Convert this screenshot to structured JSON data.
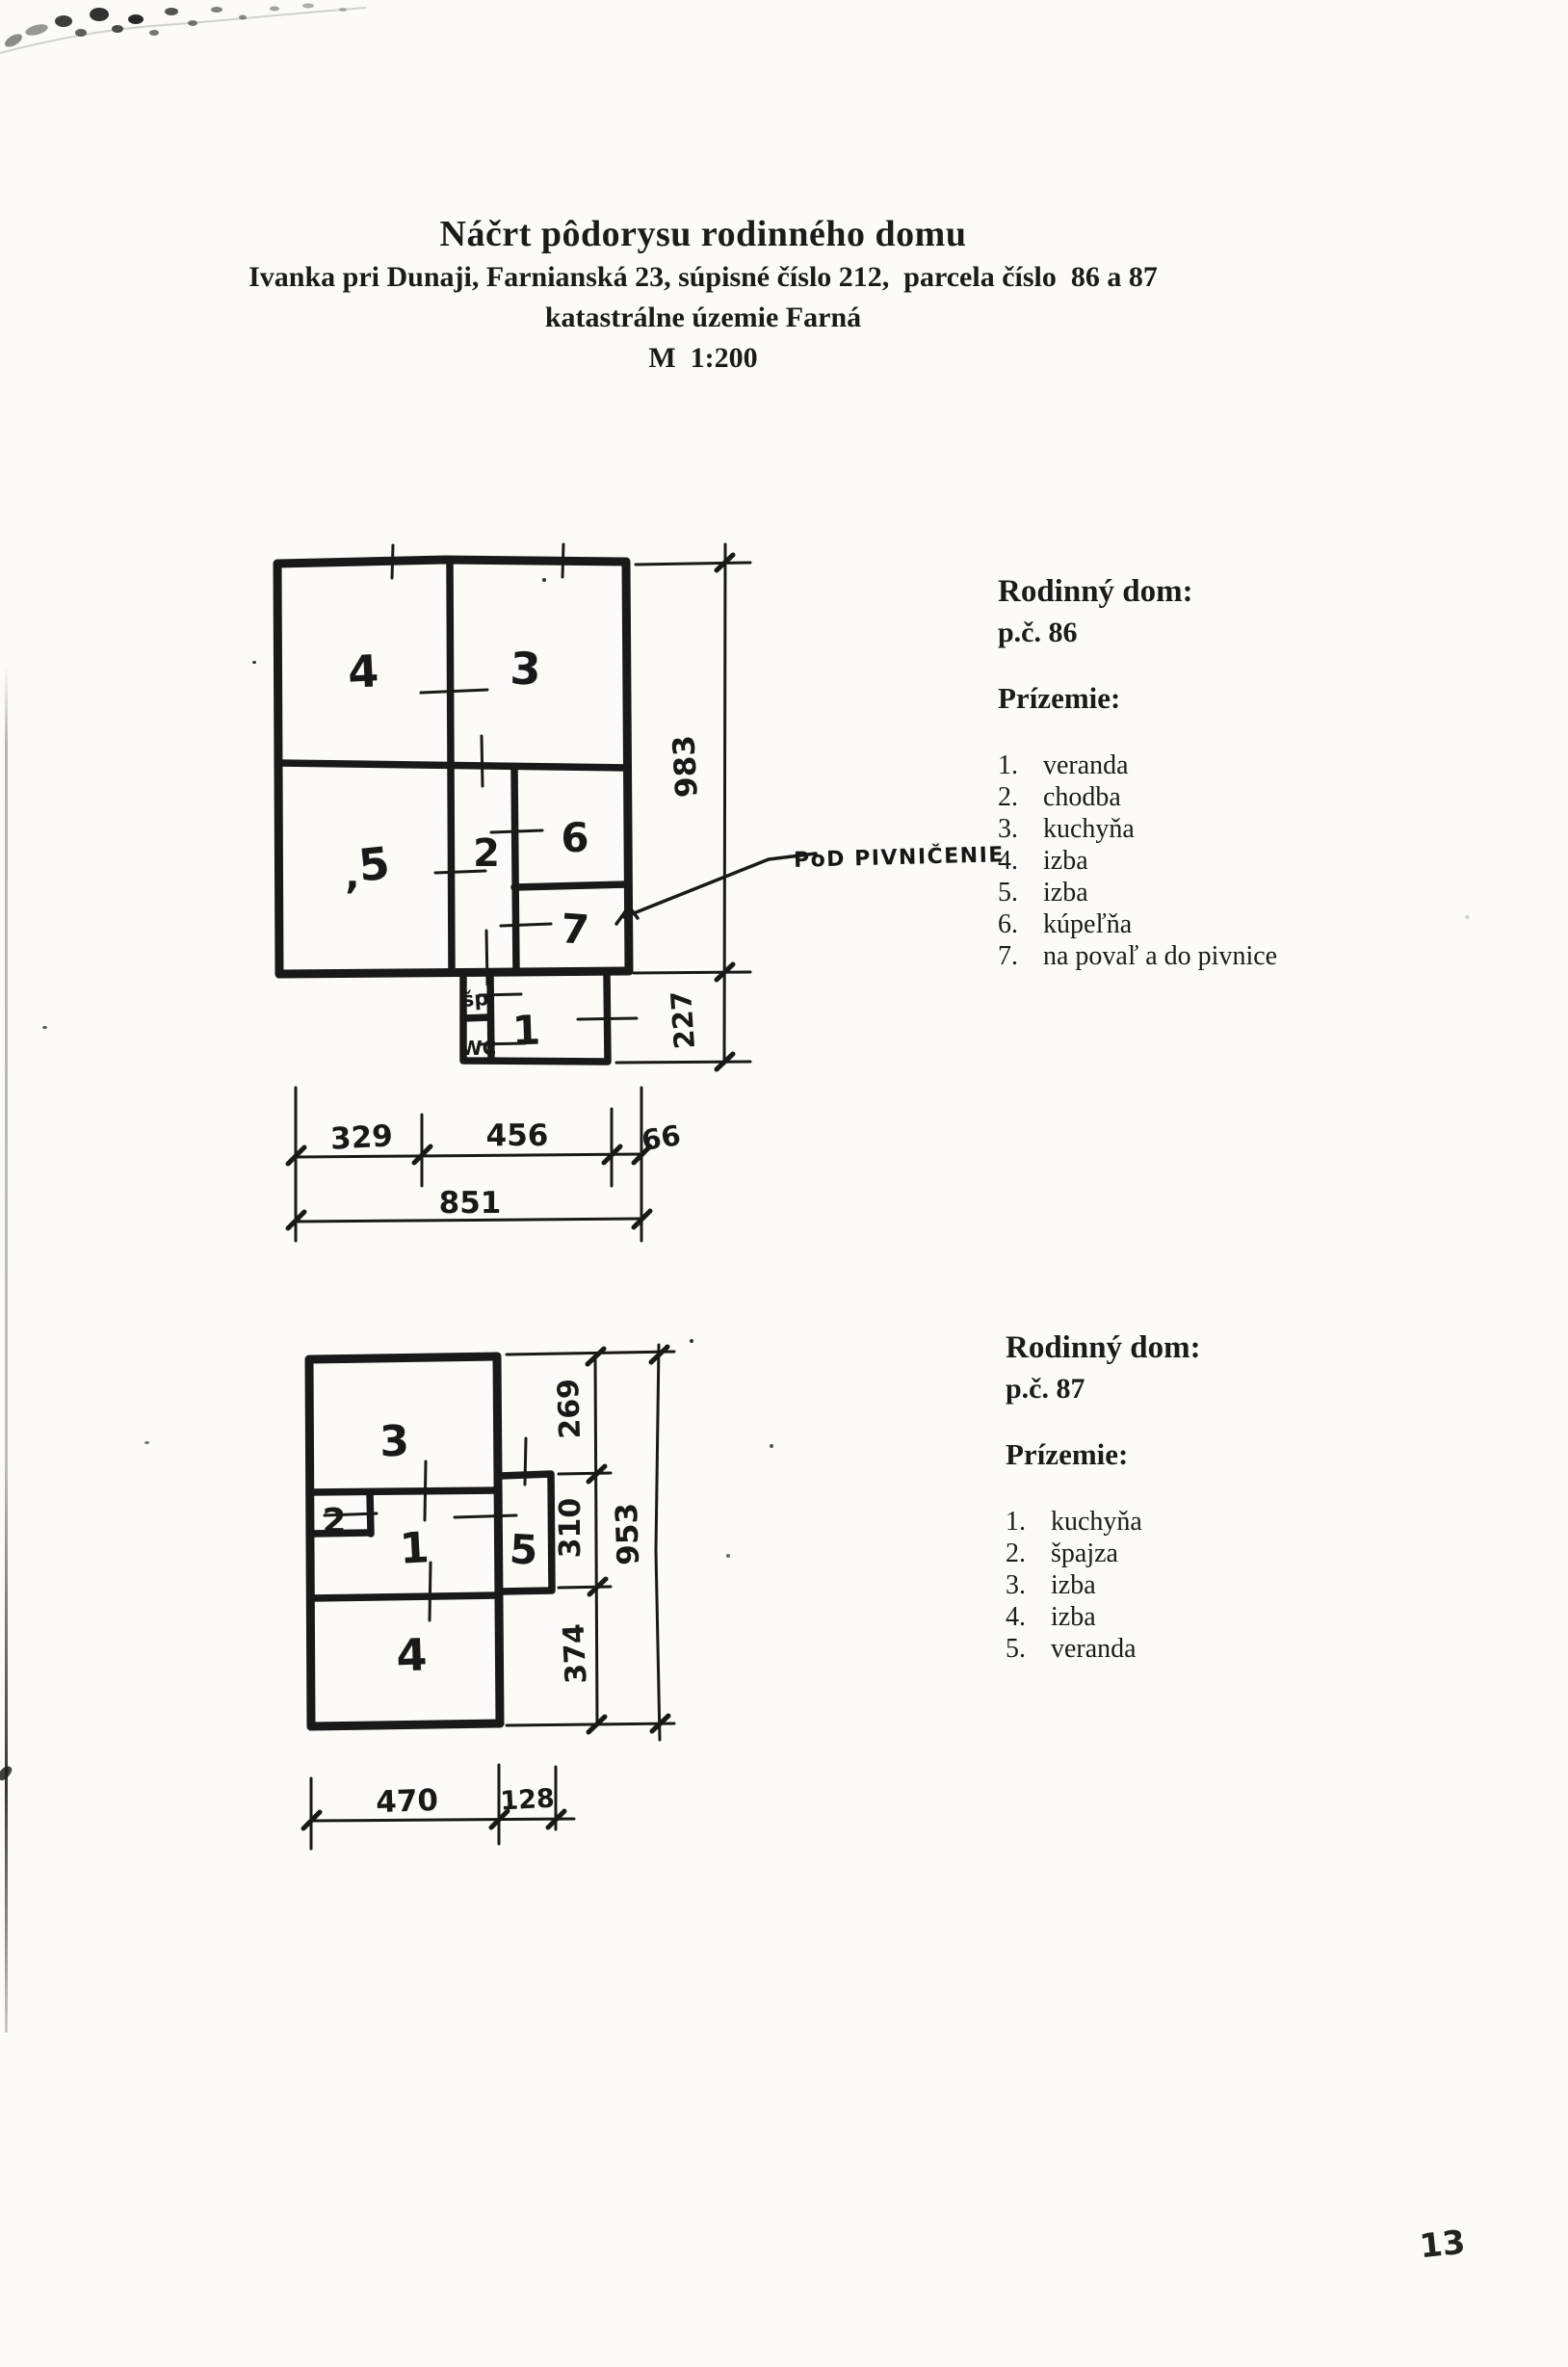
{
  "page": {
    "number": "13"
  },
  "title": {
    "line1": "Náčrt pôdorysu rodinného domu",
    "line2": "Ivanka pri Dunaji, Farnianská 23, súpisné číslo 212,  parcela číslo  86 a 87",
    "line3": "katastrálne územie Farná",
    "line4": "M  1:200"
  },
  "plan86": {
    "annotation": "PoD PIVNIČENIE",
    "rooms": {
      "r1": "1",
      "r2": "2",
      "r3": "3",
      "r4": "4",
      "r5": "5",
      "r6": "6",
      "r7": "7",
      "sp": "šp",
      "wc": "WC"
    },
    "stray_comma": ",",
    "dims": {
      "height": "983",
      "veranda_height": "227",
      "w1": "329",
      "w2": "456",
      "w3": "66",
      "total_width": "851"
    }
  },
  "legend86": {
    "heading": "Rodinný dom:",
    "parcel": "p.č. 86",
    "floor": "Prízemie:",
    "items": [
      {
        "num": "1.",
        "label": "veranda"
      },
      {
        "num": "2.",
        "label": "chodba"
      },
      {
        "num": "3.",
        "label": "kuchyňa"
      },
      {
        "num": "4.",
        "label": "izba"
      },
      {
        "num": "5.",
        "label": "izba"
      },
      {
        "num": "6.",
        "label": "kúpeľňa"
      },
      {
        "num": "7.",
        "label": "na povaľ a do pivnice"
      }
    ]
  },
  "plan87": {
    "rooms": {
      "r1": "1",
      "r2": "2",
      "r3": "3",
      "r4": "4",
      "r5": "5"
    },
    "dims": {
      "d1": "269",
      "d2": "310",
      "d3": "374",
      "total_height": "953",
      "w1": "470",
      "w2": "128"
    }
  },
  "legend87": {
    "heading": "Rodinný dom:",
    "parcel": "p.č. 87",
    "floor": "Prízemie:",
    "items": [
      {
        "num": "1.",
        "label": "kuchyňa"
      },
      {
        "num": "2.",
        "label": "špajza"
      },
      {
        "num": "3.",
        "label": "izba"
      },
      {
        "num": "4.",
        "label": "izba"
      },
      {
        "num": "5.",
        "label": "veranda"
      }
    ]
  }
}
